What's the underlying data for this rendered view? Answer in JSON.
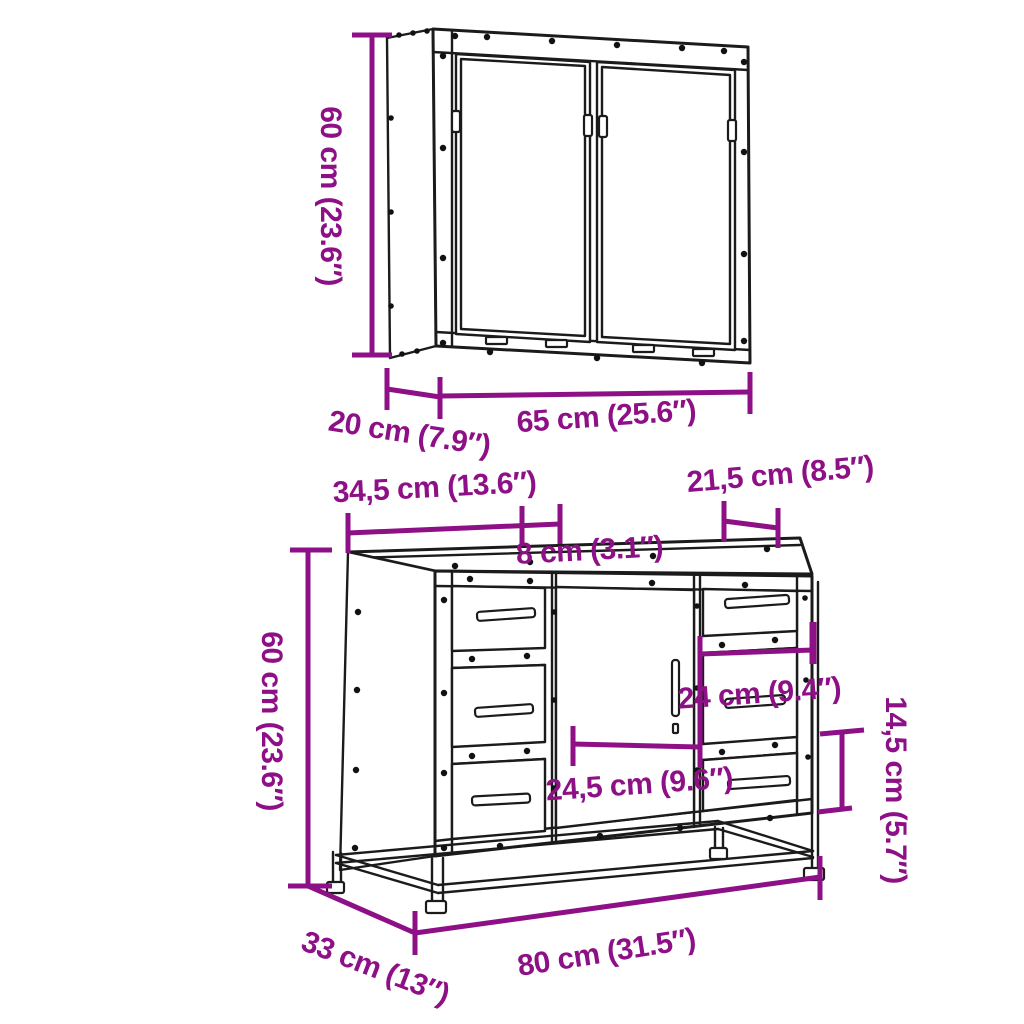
{
  "colors": {
    "dimension_accent": "#8E1086",
    "drawing_line": "#1b1b1b",
    "background": "#ffffff"
  },
  "wall_cabinet": {
    "dimensions": {
      "height": "60 cm (23.6″)",
      "depth": "20 cm (7.9″)",
      "width": "65 cm (25.6″)"
    }
  },
  "vanity_cabinet": {
    "dimensions": {
      "height": "60 cm (23.6″)",
      "width": "80 cm (31.5″)",
      "depth": "33 cm (13″)",
      "left_section_width": "34,5 cm (13.6″)",
      "top_gap": "8 cm (3.1″)",
      "right_top_depth": "21,5 cm (8.5″)",
      "door_width": "24,5 cm (9.6″)",
      "right_drawer_width": "24 cm (9.4″)",
      "right_drawer_height": "14,5 cm (5.7″)"
    }
  }
}
